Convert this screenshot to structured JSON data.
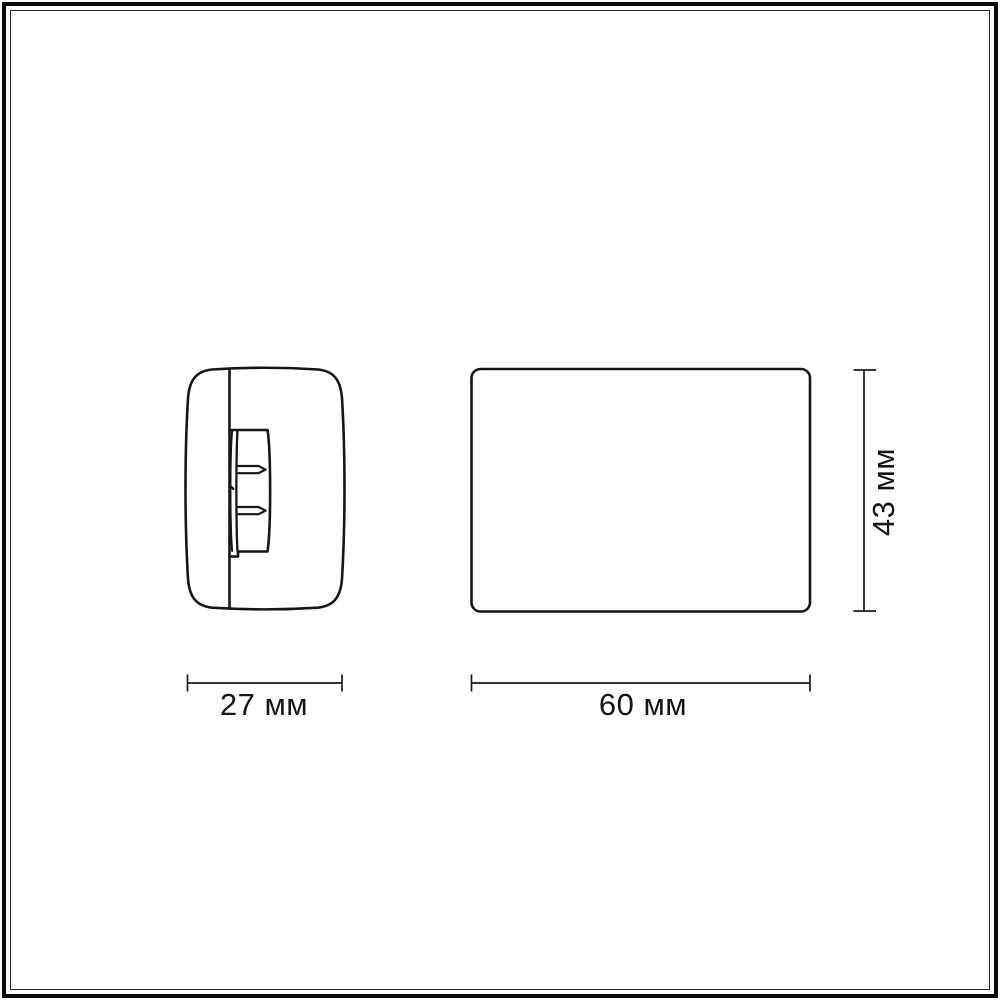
{
  "diagram": {
    "type": "technical-dimension-drawing",
    "unit": "мм",
    "line_color": "#1a1a1a",
    "background_color": "#ffffff",
    "views": [
      {
        "id": "side-view",
        "description": "side profile of fixture with mounting bracket"
      },
      {
        "id": "front-view",
        "description": "front face of fixture, rounded rectangle"
      }
    ],
    "dimensions": {
      "side_width": {
        "label": "27 мм",
        "value": 27,
        "unit": "мм",
        "applies_to": "side-view"
      },
      "front_width": {
        "label": "60 мм",
        "value": 60,
        "unit": "мм",
        "applies_to": "front-view"
      },
      "front_height": {
        "label": "43 мм",
        "value": 43,
        "unit": "мм",
        "applies_to": "front-view"
      }
    }
  }
}
